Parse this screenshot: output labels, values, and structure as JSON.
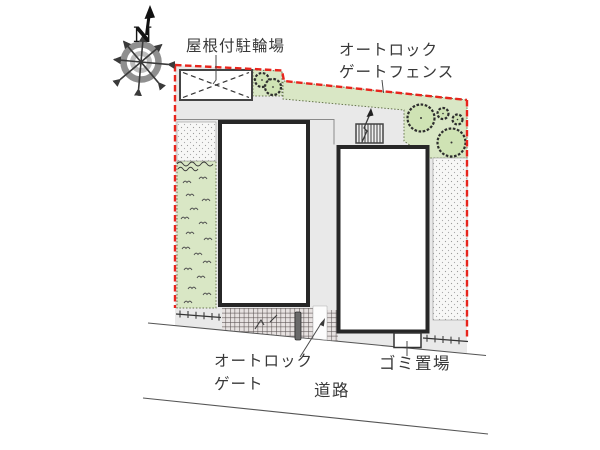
{
  "compass": {
    "north": "N"
  },
  "labels": {
    "covered_bicycle_parking": "屋根付駐輪場",
    "auto_lock_gate_fence": [
      "オートロック",
      "ゲートフェンス"
    ],
    "auto_lock_gate": [
      "オートロック",
      "ゲート"
    ],
    "road": "道路",
    "garbage_area": "ゴミ置場"
  },
  "colors": {
    "boundary_red": "#e8251d",
    "site_gray": "#e9e9e9",
    "green_area": "#d9e7c5",
    "tree_green": "#cfe3b4",
    "hatch_bg": "#e7e2e1",
    "building_fill": "#ffffff",
    "building_stroke": "#272727",
    "text_color": "#383838"
  }
}
